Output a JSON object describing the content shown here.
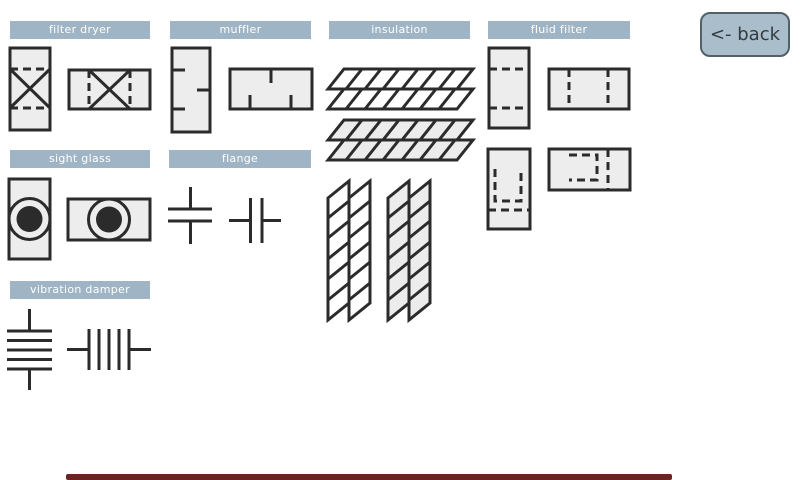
{
  "back_button": {
    "label": "<- back"
  },
  "sections": {
    "filter_dryer": {
      "label": "filter dryer"
    },
    "muffler": {
      "label": "muffler"
    },
    "insulation": {
      "label": "insulation"
    },
    "fluid_filter": {
      "label": "fluid filter"
    },
    "sight_glass": {
      "label": "sight glass"
    },
    "flange": {
      "label": "flange"
    },
    "vibration_damper": {
      "label": "vibration damper"
    }
  },
  "symbols": [
    "filter-dryer-vertical",
    "filter-dryer-horizontal",
    "muffler-vertical",
    "muffler-horizontal",
    "insulation-horizontal",
    "insulation-horizontal-filled",
    "insulation-vertical",
    "insulation-vertical-filled",
    "fluid-filter-vertical",
    "fluid-filter-horizontal",
    "fluid-filter-bag-vertical",
    "fluid-filter-bag-horizontal",
    "sight-glass-vertical",
    "sight-glass-horizontal",
    "flange-vertical",
    "flange-horizontal",
    "vibration-damper-vertical",
    "vibration-damper-horizontal"
  ],
  "colors": {
    "header_bg": "#9fb4c4",
    "header_text": "#ffffff",
    "symbol_fill": "#ededed",
    "symbol_stroke": "#2b2b2b",
    "back_button_bg": "#a9bdca",
    "back_button_border": "#52606b",
    "back_button_text": "#333b42",
    "bottom_bar": "#6f2222"
  }
}
